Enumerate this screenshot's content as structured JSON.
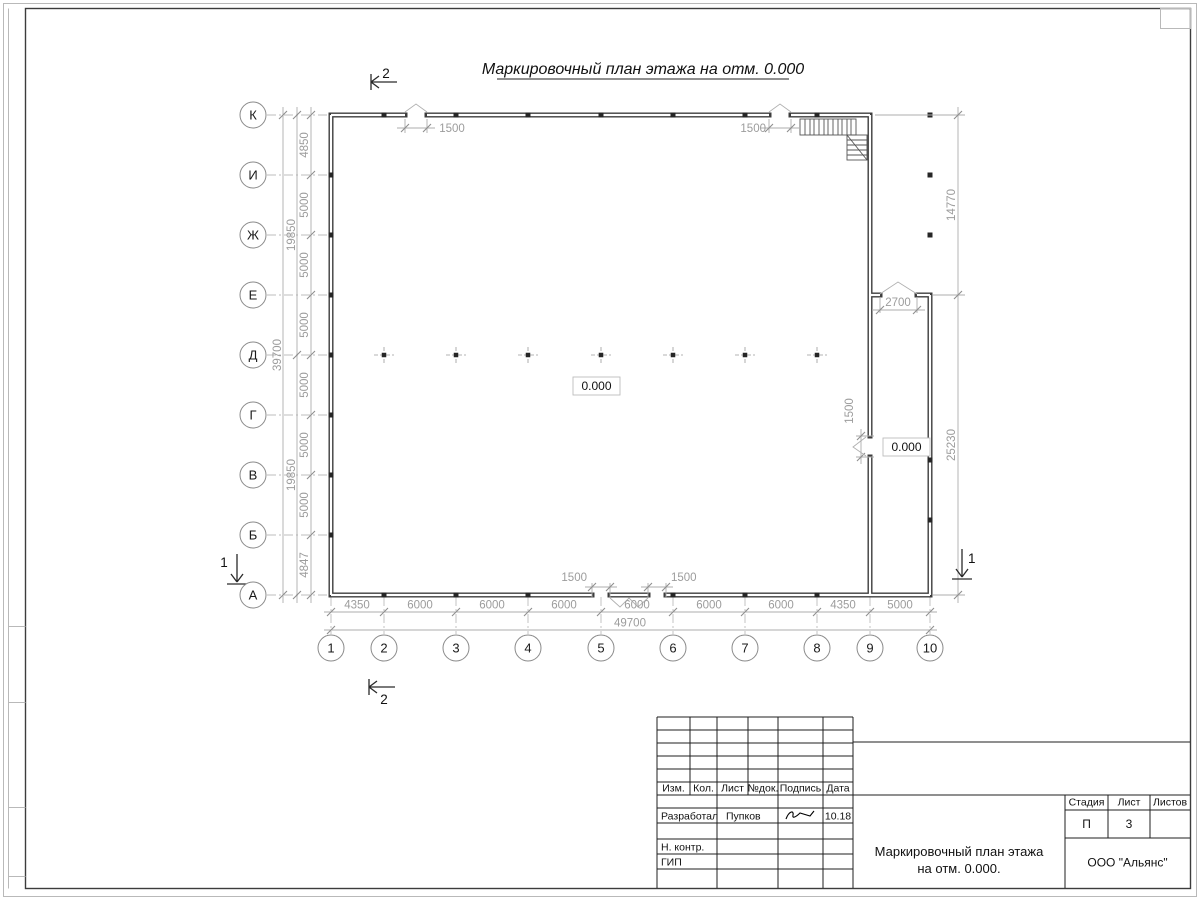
{
  "drawing": {
    "title": "Маркировочный план этажа на отм. 0.000"
  },
  "axes": {
    "rows": [
      "К",
      "И",
      "Ж",
      "Е",
      "Д",
      "Г",
      "В",
      "Б",
      "А"
    ],
    "cols": [
      "1",
      "2",
      "3",
      "4",
      "5",
      "6",
      "7",
      "8",
      "9",
      "10"
    ]
  },
  "dims": {
    "left_segments": [
      "4850",
      "5000",
      "5000",
      "5000",
      "5000",
      "5000",
      "5000",
      "4847"
    ],
    "left_half_upper": "19850",
    "left_half_lower": "19850",
    "left_total": "39700",
    "bottom_segments": [
      "4350",
      "6000",
      "6000",
      "6000",
      "6000",
      "6000",
      "6000",
      "4350",
      "5000"
    ],
    "bottom_total": "49700",
    "right_upper": "14770",
    "right_lower": "25230",
    "top_opening_1": "1500",
    "top_opening_2": "1500",
    "bottom_opening_1": "1500",
    "bottom_opening_2": "1500",
    "right_opening": "1500",
    "annex_opening": "2700"
  },
  "levels": {
    "main": "0.000",
    "annex": "0.000"
  },
  "sections": {
    "one": "1",
    "two": "2"
  },
  "titleblock": {
    "header_cols": [
      "Изм.",
      "Кол.",
      "Лист",
      "№док.",
      "Подпись",
      "Дата"
    ],
    "developed_label": "Разработал",
    "developed_name": "Пупков",
    "developed_date": "10.18",
    "ncontrol_label": "Н. контр.",
    "gip_label": "ГИП",
    "stage_label": "Стадия",
    "sheet_label": "Лист",
    "sheets_label": "Листов",
    "stage_value": "П",
    "sheet_value": "3",
    "doc_title_line1": "Маркировочный план этажа",
    "doc_title_line2": "на отм. 0.000.",
    "company": "ООО \"Альянс\""
  }
}
